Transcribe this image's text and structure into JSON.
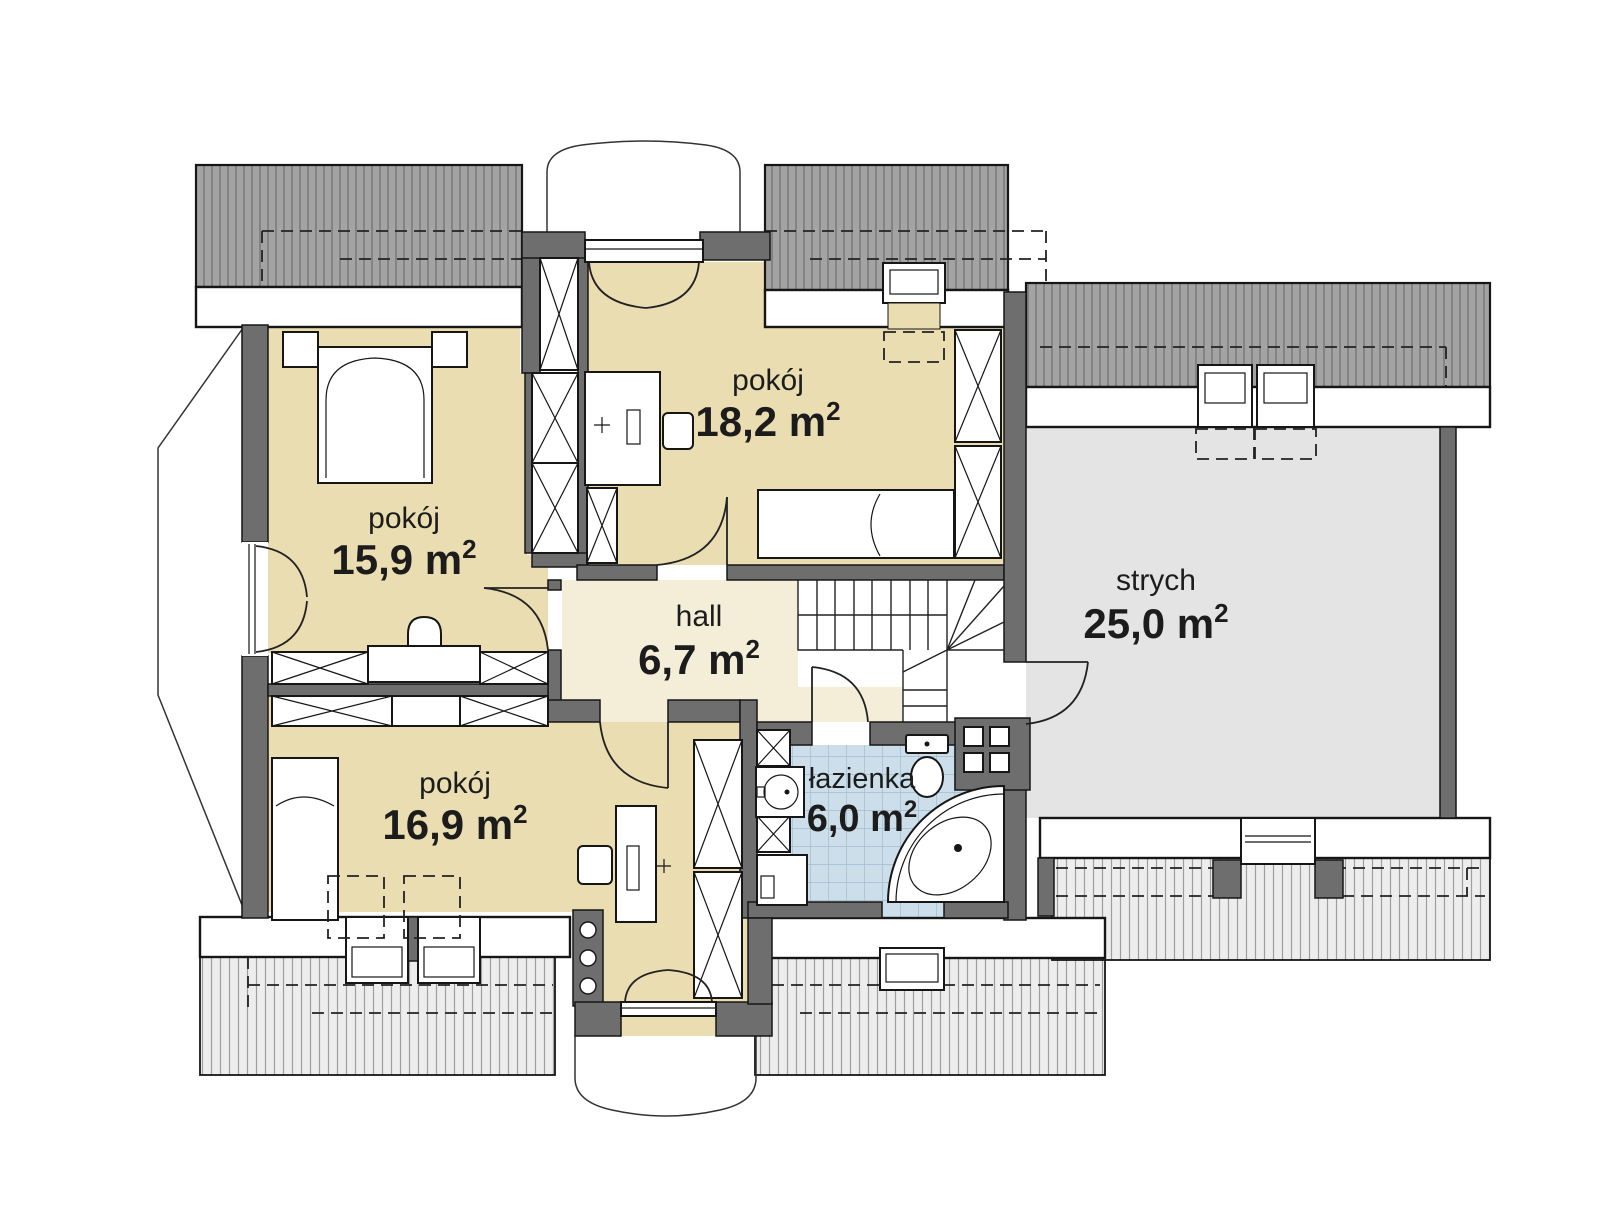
{
  "rooms": [
    {
      "id": "pokoj-1",
      "name": "pokój",
      "area": "15,9 m",
      "sup": "2"
    },
    {
      "id": "pokoj-2",
      "name": "pokój",
      "area": "18,2 m",
      "sup": "2"
    },
    {
      "id": "pokoj-3",
      "name": "pokój",
      "area": "16,9 m",
      "sup": "2"
    },
    {
      "id": "hall",
      "name": "hall",
      "area": "6,7 m",
      "sup": "2"
    },
    {
      "id": "lazienka",
      "name": "łazienka",
      "area": "6,0 m",
      "sup": "2"
    },
    {
      "id": "strych",
      "name": "strych",
      "area": "25,0 m",
      "sup": "2"
    }
  ],
  "colors": {
    "room_fill": "#eaddb1",
    "hall_fill": "#f4eed9",
    "bathroom_fill": "#cbdee9",
    "attic_fill": "#e4e4e4",
    "roof_dark": "#a3a3a3",
    "roof_light": "#ededed",
    "wall": "#6e6e6e",
    "outline": "#161616",
    "text": "#1c1c1c"
  }
}
